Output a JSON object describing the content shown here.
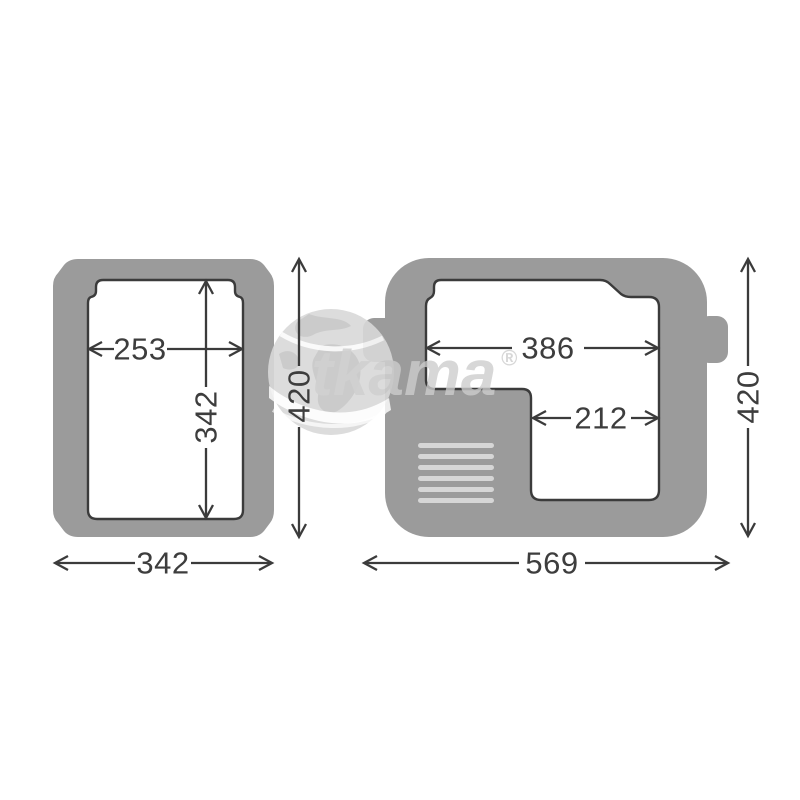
{
  "brand_watermark": {
    "text": "tkama",
    "registered": "®"
  },
  "colors": {
    "background": "#ffffff",
    "body": "#9b9b9b",
    "cavity_fill": "#ffffff",
    "cavity_outline": "#3b3b3b",
    "dimension_line": "#3b3b3b",
    "dimension_text": "#3d3d3d",
    "vent_slat": "#d6d6d6",
    "watermark_text": "#cccccc",
    "globe": "#d9d9d9"
  },
  "left_view": {
    "dimensions": {
      "inner_width": "253",
      "inner_depth": "342",
      "overall_depth": "420",
      "overall_width": "342"
    }
  },
  "right_view": {
    "dimensions": {
      "inner_width": "386",
      "compartment_width": "212",
      "overall_depth": "420",
      "overall_width": "569"
    }
  }
}
